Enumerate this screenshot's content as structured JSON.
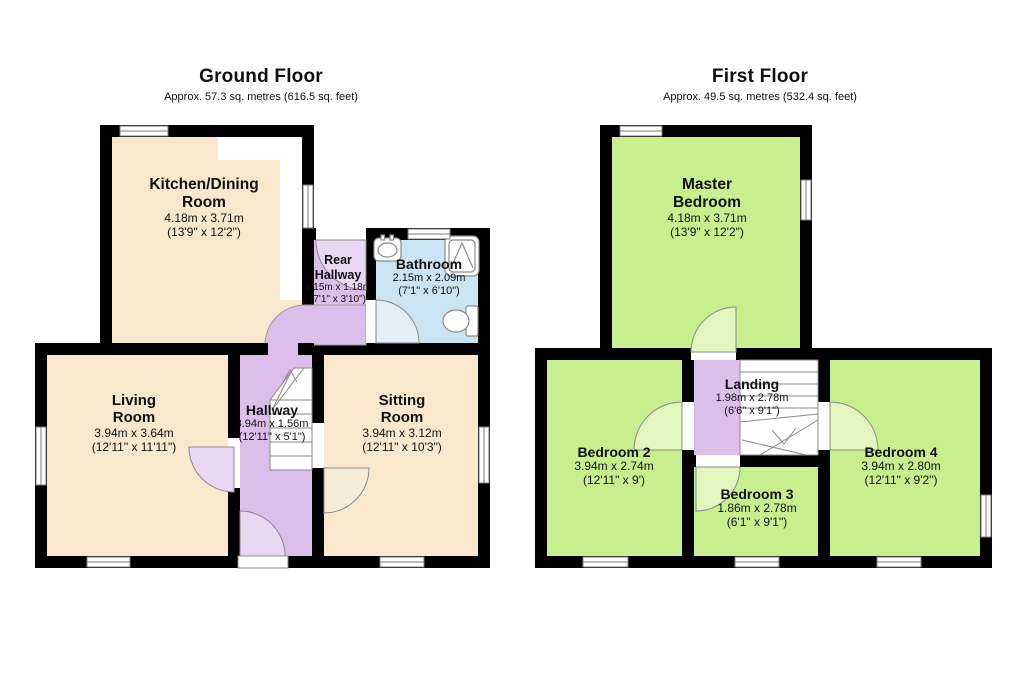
{
  "colors": {
    "wall": "#000000",
    "room_cream": "#F9E8CD",
    "room_purple": "#DCBEEB",
    "room_blue": "#CBE4F3",
    "room_green": "#C7EF8D",
    "door_purple": "#E9D7F3",
    "door_cream": "#F6ECD7",
    "door_blue": "#E2EFF8",
    "door_green": "#E3F6BE",
    "outline_gray": "#7b7b7b",
    "white": "#ffffff"
  },
  "icons": {
    "sink": "oval-basin-with-taps",
    "shower": "square-shower-tray",
    "toilet": "bowl-and-cistern",
    "stairs": "tread-run-with-break",
    "door": "quarter-circle-swing-arc",
    "window": "double-line-wall-opening"
  },
  "floors": [
    {
      "id": "ground",
      "title": "Ground Floor",
      "subtitle": "Approx. 57.3 sq. metres (616.5 sq. feet)",
      "rooms": [
        {
          "key": "kitchen",
          "name": "Kitchen/Dining Room",
          "metric": "4.18m x 3.71m",
          "imperial": "(13'9\" x 12'2\")"
        },
        {
          "key": "rear-hallway",
          "name": "Rear Hallway",
          "metric": "2.15m x 1.18m",
          "imperial": "(7'1\" x 3'10\")"
        },
        {
          "key": "bathroom",
          "name": "Bathroom",
          "metric": "2.15m x 2.09m",
          "imperial": "(7'1\" x 6'10\")"
        },
        {
          "key": "living-room",
          "name": "Living Room",
          "metric": "3.94m x 3.64m",
          "imperial": "(12'11\" x 11'11\")"
        },
        {
          "key": "hallway",
          "name": "Hallway",
          "metric": "3.94m x 1.56m",
          "imperial": "(12'11\" x 5'1\")"
        },
        {
          "key": "sitting-room",
          "name": "Sitting Room",
          "metric": "3.94m x 3.12m",
          "imperial": "(12'11\" x 10'3\")"
        }
      ]
    },
    {
      "id": "first",
      "title": "First Floor",
      "subtitle": "Approx. 49.5 sq. metres (532.4 sq. feet)",
      "rooms": [
        {
          "key": "master-bedroom",
          "name": "Master Bedroom",
          "metric": "4.18m x 3.71m",
          "imperial": "(13'9\" x 12'2\")"
        },
        {
          "key": "landing",
          "name": "Landing",
          "metric": "1.98m x 2.78m",
          "imperial": "(6'6\" x 9'1\")"
        },
        {
          "key": "bedroom-2",
          "name": "Bedroom 2",
          "metric": "3.94m x 2.74m",
          "imperial": "(12'11\" x 9')"
        },
        {
          "key": "bedroom-3",
          "name": "Bedroom 3",
          "metric": "1.86m x 2.78m",
          "imperial": "(6'1\" x 9'1\")"
        },
        {
          "key": "bedroom-4",
          "name": "Bedroom 4",
          "metric": "3.94m x 2.80m",
          "imperial": "(12'11\" x 9'2\")"
        }
      ]
    }
  ]
}
